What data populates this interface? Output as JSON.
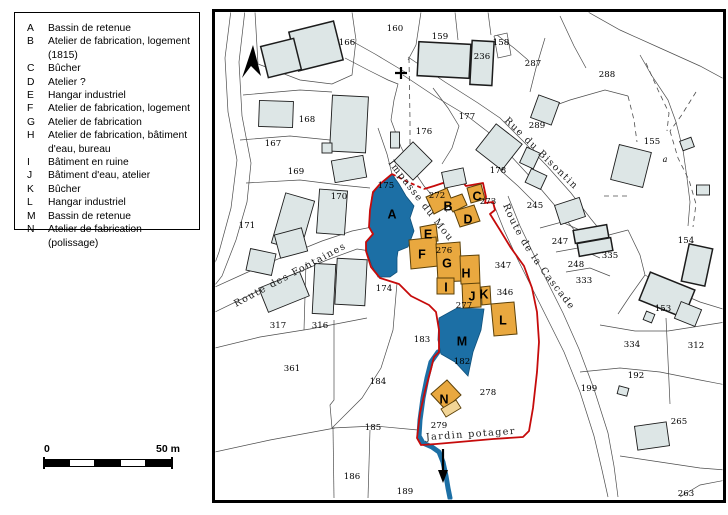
{
  "colors": {
    "site_building": "#e9a83f",
    "site_building_pale": "#f2d596",
    "site_outline": "#5b4008",
    "water_blue": "#1c6fa5",
    "boundary_red": "#c60b0b",
    "gray_building_fill": "#dde6e6",
    "gray_building_line": "#1c1c1c",
    "parcel_line": "#4d4d4d"
  },
  "legend": {
    "items": [
      {
        "key": "A",
        "label": "Bassin de retenue"
      },
      {
        "key": "B",
        "label": "Atelier de fabrication, logement (1815)"
      },
      {
        "key": "C",
        "label": "Bûcher"
      },
      {
        "key": "D",
        "label": "Atelier ?"
      },
      {
        "key": "E",
        "label": "Hangar industriel"
      },
      {
        "key": "F",
        "label": "Atelier de fabrication, logement"
      },
      {
        "key": "G",
        "label": "Atelier de fabrication"
      },
      {
        "key": "H",
        "label": "Atelier de fabrication, bâtiment d'eau, bureau"
      },
      {
        "key": "I",
        "label": "Bâtiment en ruine"
      },
      {
        "key": "J",
        "label": "Bâtiment d'eau, atelier"
      },
      {
        "key": "K",
        "label": "Bûcher"
      },
      {
        "key": "L",
        "label": "Hangar industriel"
      },
      {
        "key": "M",
        "label": "Bassin de retenue"
      },
      {
        "key": "N",
        "label": "Atelier de fabrication (polissage)"
      }
    ]
  },
  "scalebar": {
    "zero": "0",
    "fifty": "50 m"
  },
  "map": {
    "streets": [
      {
        "name": "Route des Fontaines",
        "path": "M 236,307 L 350,246",
        "spacing": 1.6
      },
      {
        "name": "Impasse du Moulin",
        "path": "M 388,163 L 450,243",
        "spacing": 0.6
      },
      {
        "name": "Rue du Bisontin",
        "path": "M 504,121 L 584,199",
        "spacing": 2.0
      },
      {
        "name": "Route de la Cascade",
        "path": "M 503,205 C 518,243 536,266 572,312",
        "spacing": 0.8
      }
    ],
    "parcels": [
      {
        "n": "166",
        "x": 347,
        "y": 45
      },
      {
        "n": "160",
        "x": 395,
        "y": 31
      },
      {
        "n": "159",
        "x": 440,
        "y": 39
      },
      {
        "n": "236",
        "x": 482,
        "y": 59
      },
      {
        "n": "158",
        "x": 501,
        "y": 45
      },
      {
        "n": "287",
        "x": 533,
        "y": 66
      },
      {
        "n": "288",
        "x": 607,
        "y": 77
      },
      {
        "n": "289",
        "x": 537,
        "y": 128
      },
      {
        "n": "177",
        "x": 467,
        "y": 119
      },
      {
        "n": "176",
        "x": 424,
        "y": 134
      },
      {
        "n": "178",
        "x": 498,
        "y": 173
      },
      {
        "n": "167",
        "x": 273,
        "y": 146
      },
      {
        "n": "168",
        "x": 307,
        "y": 122
      },
      {
        "n": "169",
        "x": 296,
        "y": 174
      },
      {
        "n": "170",
        "x": 339,
        "y": 199
      },
      {
        "n": "171",
        "x": 247,
        "y": 228
      },
      {
        "n": "175",
        "x": 386,
        "y": 188
      },
      {
        "n": "272",
        "x": 437,
        "y": 198
      },
      {
        "n": "273",
        "x": 488,
        "y": 204
      },
      {
        "n": "245",
        "x": 535,
        "y": 208
      },
      {
        "n": "247",
        "x": 560,
        "y": 244
      },
      {
        "n": "335",
        "x": 610,
        "y": 258
      },
      {
        "n": "248",
        "x": 576,
        "y": 267
      },
      {
        "n": "333",
        "x": 584,
        "y": 283
      },
      {
        "n": "155",
        "x": 652,
        "y": 144
      },
      {
        "n": "a",
        "x": 665,
        "y": 162,
        "it": true
      },
      {
        "n": "154",
        "x": 686,
        "y": 243
      },
      {
        "n": "153",
        "x": 663,
        "y": 311
      },
      {
        "n": "334",
        "x": 632,
        "y": 347
      },
      {
        "n": "312",
        "x": 696,
        "y": 348
      },
      {
        "n": "174",
        "x": 384,
        "y": 291
      },
      {
        "n": "317",
        "x": 278,
        "y": 328
      },
      {
        "n": "316",
        "x": 320,
        "y": 328
      },
      {
        "n": "276",
        "x": 444,
        "y": 253
      },
      {
        "n": "347",
        "x": 503,
        "y": 268
      },
      {
        "n": "346",
        "x": 505,
        "y": 295
      },
      {
        "n": "277",
        "x": 464,
        "y": 308
      },
      {
        "n": "182",
        "x": 462,
        "y": 364
      },
      {
        "n": "183",
        "x": 422,
        "y": 342
      },
      {
        "n": "361",
        "x": 292,
        "y": 371
      },
      {
        "n": "184",
        "x": 378,
        "y": 384
      },
      {
        "n": "185",
        "x": 373,
        "y": 430
      },
      {
        "n": "186",
        "x": 352,
        "y": 479
      },
      {
        "n": "189",
        "x": 405,
        "y": 494
      },
      {
        "n": "278",
        "x": 488,
        "y": 395
      },
      {
        "n": "279",
        "x": 439,
        "y": 428
      },
      {
        "n": "192",
        "x": 636,
        "y": 378
      },
      {
        "n": "199",
        "x": 589,
        "y": 391
      },
      {
        "n": "265",
        "x": 679,
        "y": 424
      },
      {
        "n": "263",
        "x": 686,
        "y": 496
      }
    ],
    "letters": [
      {
        "k": "A",
        "x": 392,
        "y": 214
      },
      {
        "k": "B",
        "x": 448,
        "y": 206
      },
      {
        "k": "C",
        "x": 477,
        "y": 196
      },
      {
        "k": "D",
        "x": 468,
        "y": 219
      },
      {
        "k": "E",
        "x": 428,
        "y": 234
      },
      {
        "k": "F",
        "x": 422,
        "y": 254
      },
      {
        "k": "G",
        "x": 447,
        "y": 263
      },
      {
        "k": "H",
        "x": 466,
        "y": 273
      },
      {
        "k": "I",
        "x": 446,
        "y": 287
      },
      {
        "k": "J",
        "x": 472,
        "y": 296
      },
      {
        "k": "K",
        "x": 484,
        "y": 294
      },
      {
        "k": "L",
        "x": 503,
        "y": 320
      },
      {
        "k": "M",
        "x": 462,
        "y": 341
      },
      {
        "k": "N",
        "x": 444,
        "y": 399
      }
    ],
    "jardin_label": {
      "text": "Jardin potager",
      "x": 471,
      "y": 437,
      "rot": -4
    }
  }
}
